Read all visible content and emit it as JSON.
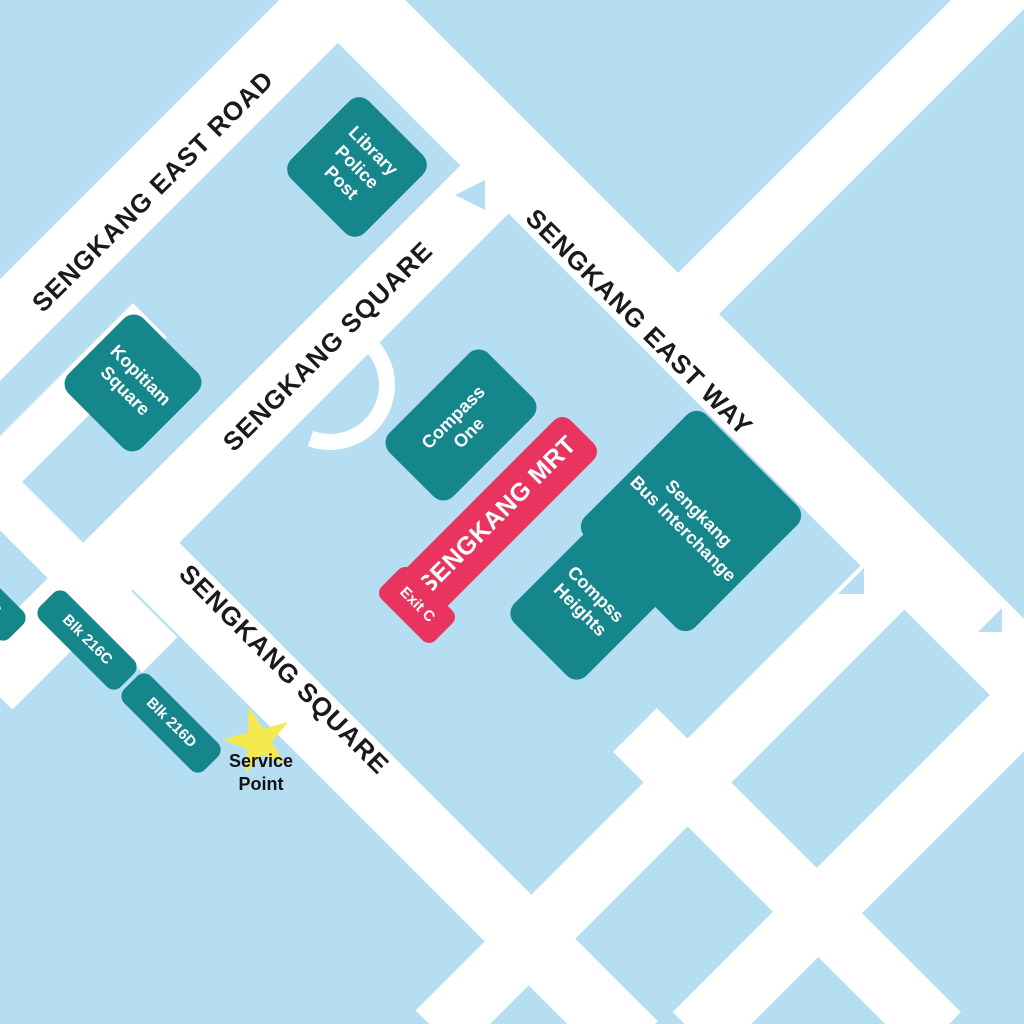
{
  "colors": {
    "background": "#B6DEF3",
    "road": "#FFFFFF",
    "building": "#15868C",
    "transit_highlight": "#E8345F",
    "star": "#F5E94E",
    "road_label": "#1A1A1A",
    "building_label": "#FFFFFF"
  },
  "roads": {
    "east_road": "SENGKANG EAST ROAD",
    "square_upper": "SENGKANG SQUARE",
    "east_way": "SENGKANG EAST WAY",
    "square_lower": "SENGKANG SQUARE"
  },
  "buildings": {
    "library_police_post": "Library\nPolice\nPost",
    "kopitiam_square": "Kopitiam\nSquare",
    "compass_one": "Compass\nOne",
    "compss_heights": "Compss\nHeights",
    "bus_interchange": "Sengkang\nBus Interchange",
    "blk_216b": "Blk 216B",
    "blk_216c": "Blk 216C",
    "blk_216d": "Blk 216D"
  },
  "transit": {
    "station": "SENGKANG MRT",
    "exit": "Exit C"
  },
  "marker": {
    "service_point": "Service\nPoint"
  }
}
